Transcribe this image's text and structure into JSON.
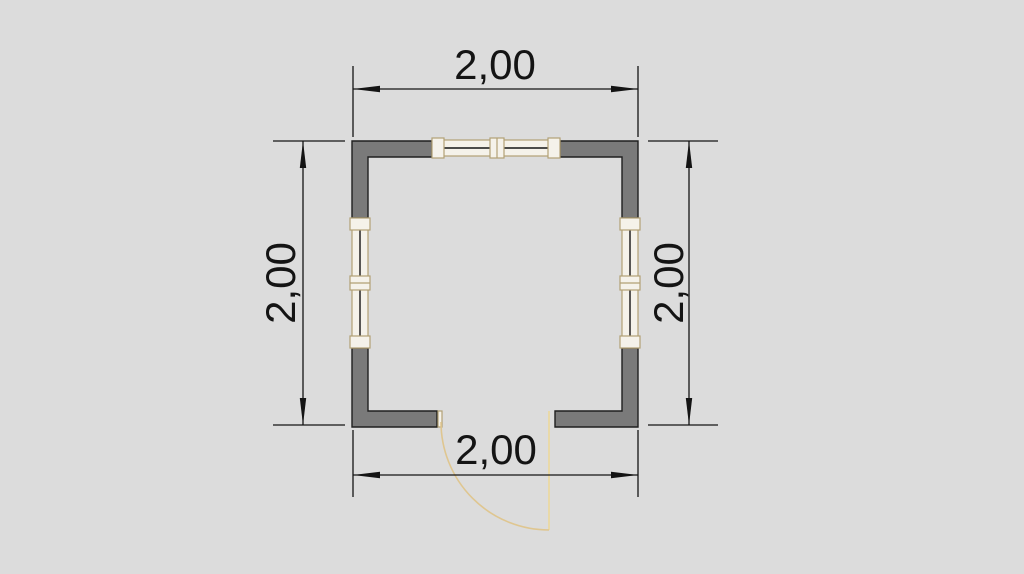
{
  "plan": {
    "dimension_labels": {
      "top": "2,00",
      "bottom": "2,00",
      "left": "2,00",
      "right": "2,00"
    }
  },
  "colors": {
    "background": "#dcdcdc",
    "wall_fill": "#7a7a7a",
    "wall_outline": "#1f1f1f",
    "dimension_line": "#141414",
    "dimension_text": "#141414",
    "window_frame": "#b2a175",
    "window_fill": "#f5f2ea",
    "glass_line": "#141414",
    "door_arc": "#dfc690",
    "door_leaf": "#e9d9a8"
  }
}
